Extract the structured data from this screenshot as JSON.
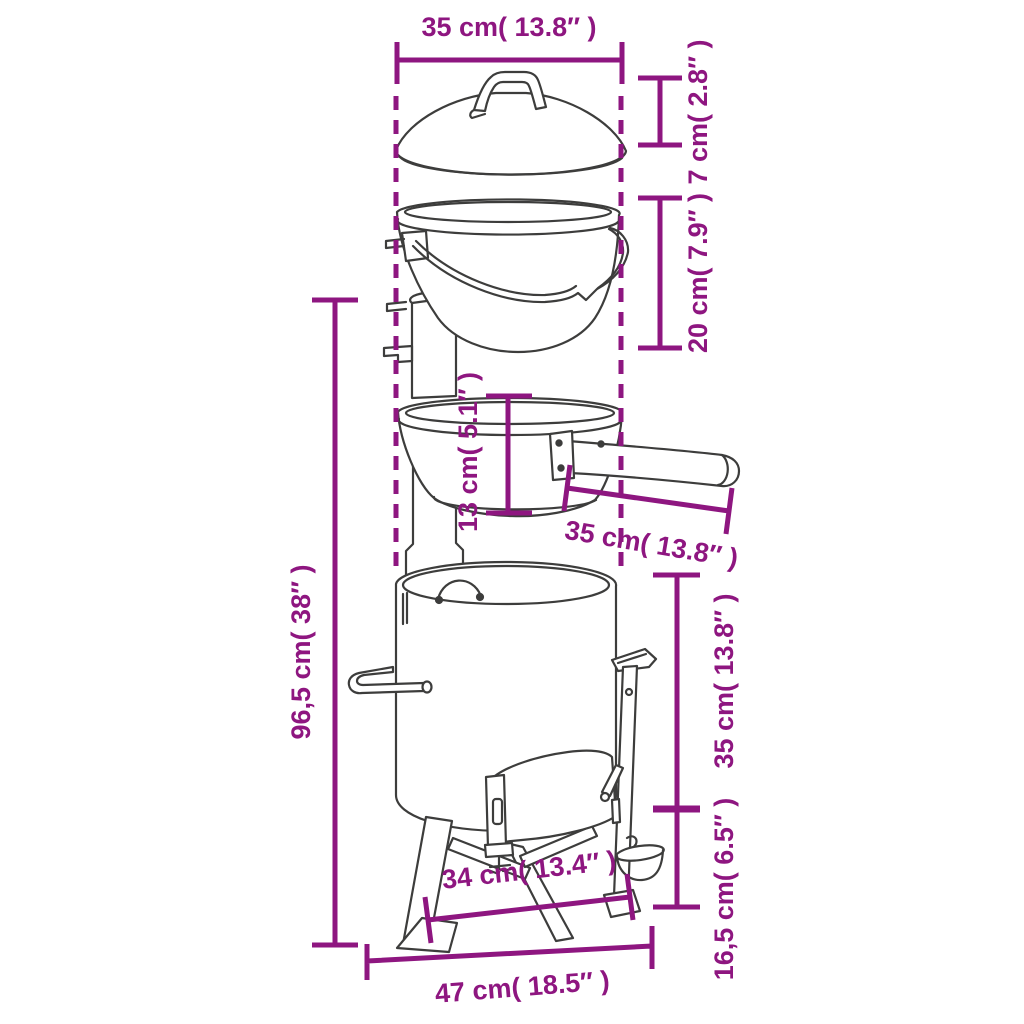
{
  "diagram": {
    "type": "product-dimensions-line-drawing",
    "labels": {
      "lid_width": "35 cm( 13.8″ )",
      "lid_height": "7 cm( 2.8″ )",
      "pot_height": "20 cm( 7.9″ )",
      "pan_height": "13 cm( 5.1″ )",
      "pan_width": "35 cm( 13.8″ )",
      "total_height": "96,5 cm( 38″ )",
      "body_height": "35 cm( 13.8″ )",
      "base_width": "34 cm( 13.4″ )",
      "leg_height": "16,5 cm( 6.5″ )",
      "overall_width": "47 cm( 18.5″ )"
    }
  },
  "colors": {
    "dimension": "#8E1680",
    "line_art": "#3D3D3C",
    "background": "#FFFFFF"
  }
}
